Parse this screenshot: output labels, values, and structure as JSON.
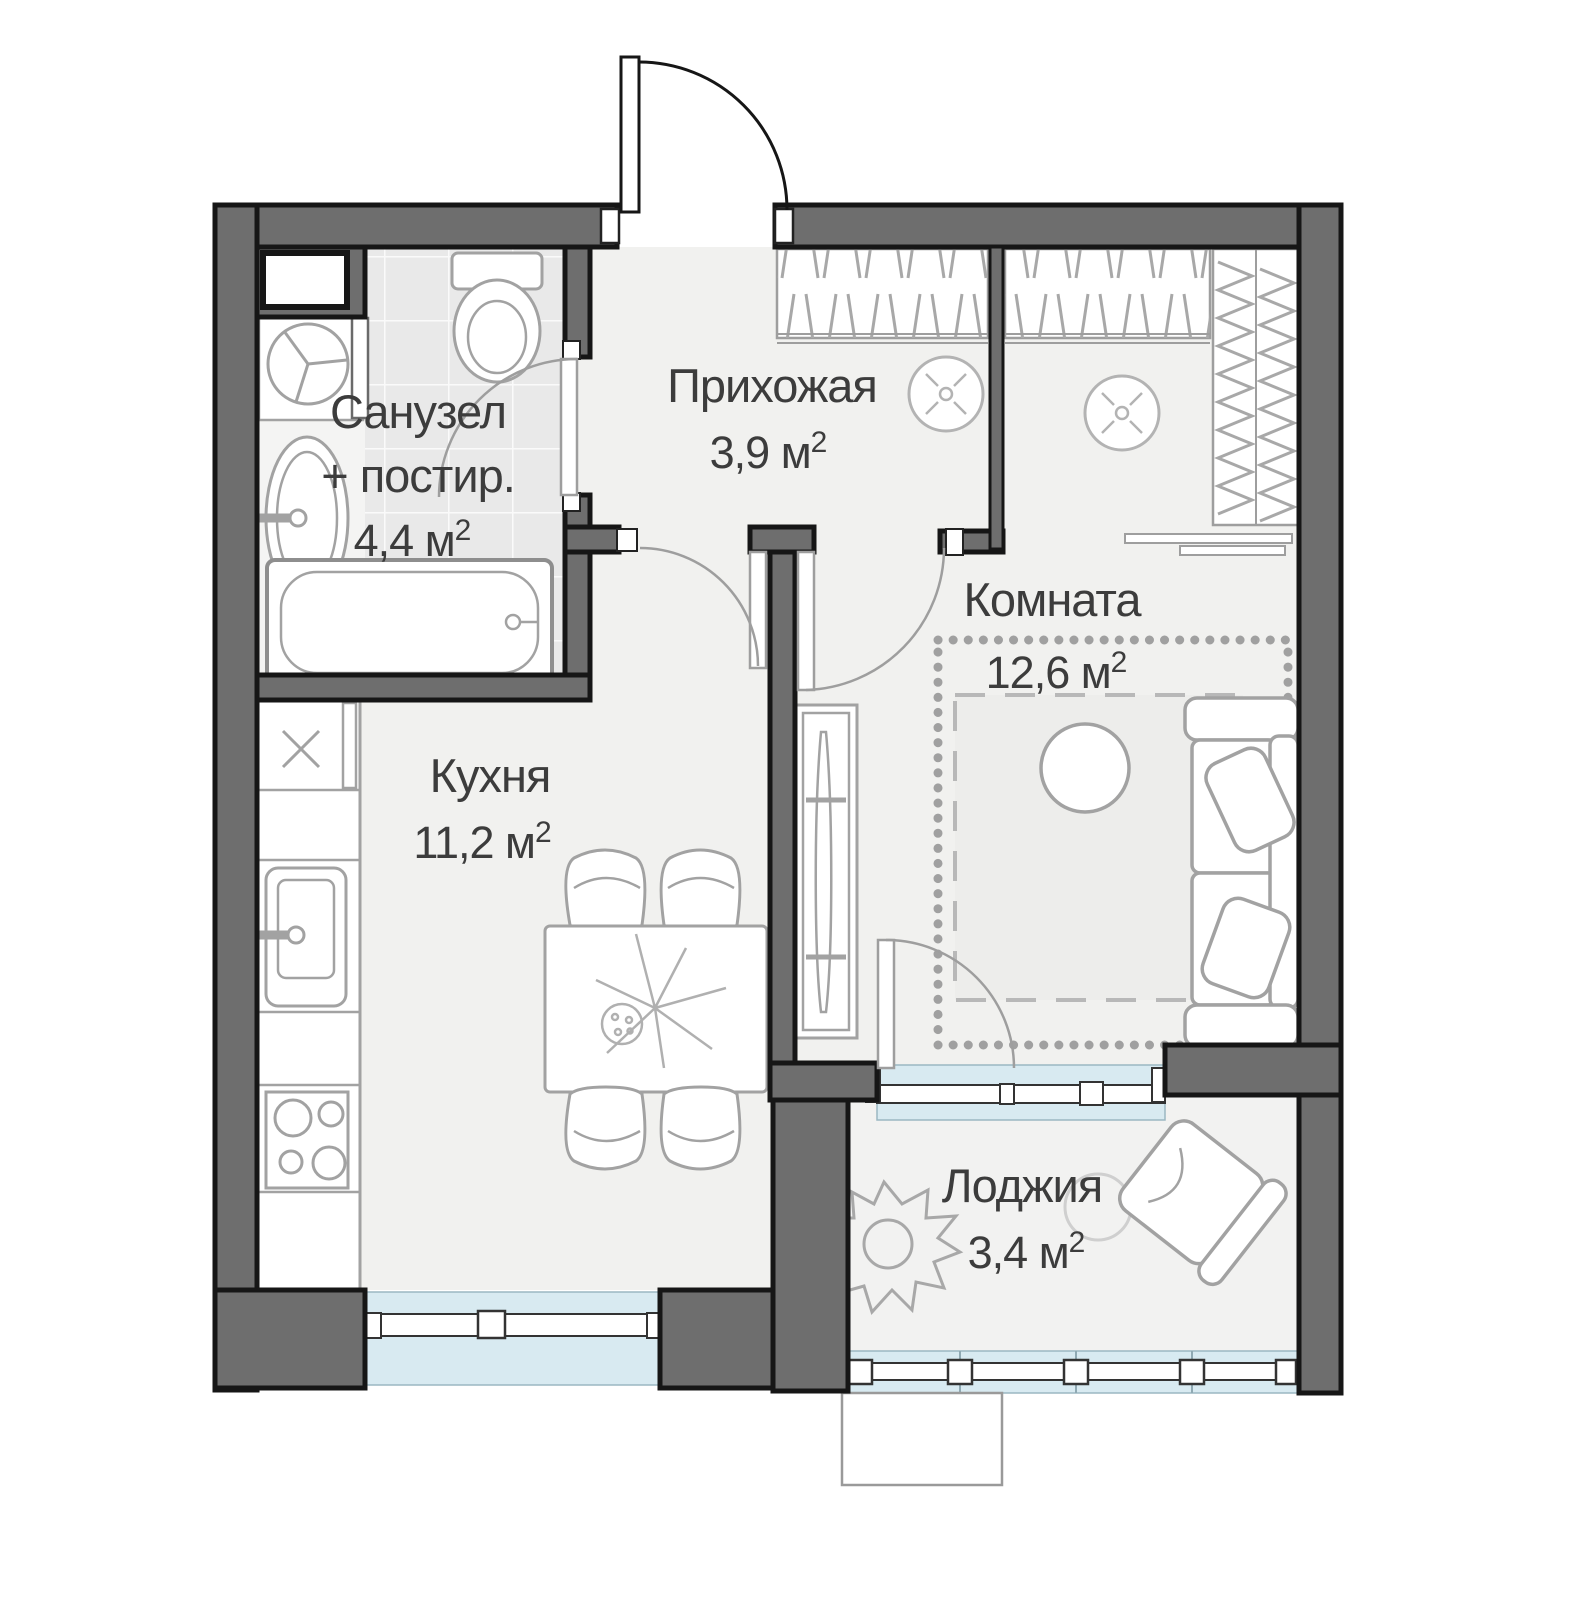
{
  "plan": {
    "title": "apartment-floor-plan",
    "colors": {
      "wall": "#6e6e6e",
      "wall_outline": "#161616",
      "floor": "#f1f1ef",
      "bathroom_tile": "#e9e9e9",
      "window_glass": "#d8eaf1",
      "furniture_stroke": "#a2a2a2",
      "ornament": "#a0a0a0",
      "text": "#3c3c3c"
    },
    "rooms": {
      "bathroom": {
        "name": "Санузел",
        "name2": "+ постир.",
        "area": "4,4 м",
        "sup": "2"
      },
      "hallway": {
        "name": "Прихожая",
        "area": "3,9 м",
        "sup": "2"
      },
      "living": {
        "name": "Комната",
        "area": "12,6 м",
        "sup": "2"
      },
      "kitchen": {
        "name": "Кухня",
        "area": "11,2 м",
        "sup": "2"
      },
      "loggia": {
        "name": "Лоджия",
        "area": "3,4 м",
        "sup": "2"
      }
    }
  }
}
